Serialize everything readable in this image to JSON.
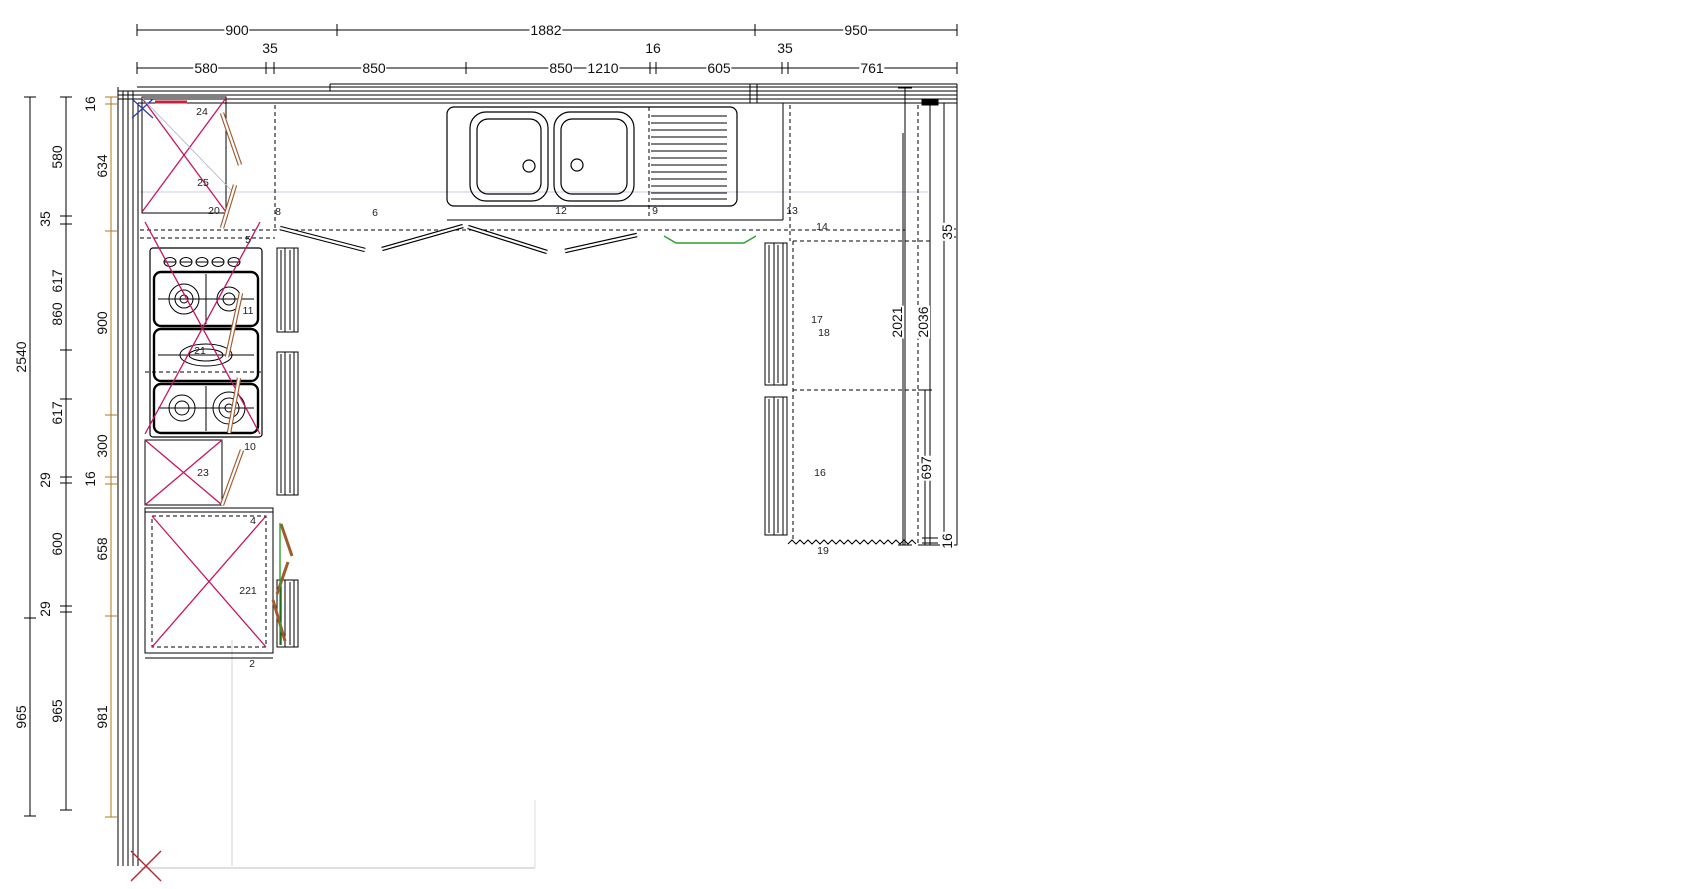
{
  "canvas": {
    "width": 1684,
    "height": 889,
    "background": "#ffffff"
  },
  "colors": {
    "line": "#000000",
    "magenta_cross": "#c81464",
    "crimson_mark": "#c0233a",
    "blue_mark": "#2939b0",
    "brown_door": "#a05a2c",
    "orange_chain": "#b07820",
    "green_highlight": "#2ca02c",
    "lavender_guide": "#c8c8e8",
    "gray_guide": "#cccccc"
  },
  "dimensions": {
    "top_row1": [
      {
        "t": "900",
        "x": 237,
        "y": 30
      },
      {
        "t": "1882",
        "x": 546,
        "y": 30
      },
      {
        "t": "950",
        "x": 856,
        "y": 30
      }
    ],
    "top_row2": [
      {
        "t": "580",
        "x": 206,
        "y": 68
      },
      {
        "t": "850",
        "x": 374,
        "y": 68
      },
      {
        "t": "850",
        "x": 561,
        "y": 68
      },
      {
        "t": "1210",
        "x": 603,
        "y": 68
      },
      {
        "t": "605",
        "x": 719,
        "y": 68
      },
      {
        "t": "761",
        "x": 872,
        "y": 68
      }
    ],
    "top_small": [
      {
        "t": "35",
        "x": 270,
        "y": 48
      },
      {
        "t": "16",
        "x": 653,
        "y": 48
      },
      {
        "t": "35",
        "x": 785,
        "y": 48
      }
    ],
    "left": [
      {
        "t": "2540",
        "x": 21,
        "y": 357
      },
      {
        "t": "965",
        "x": 21,
        "y": 717
      },
      {
        "t": "580",
        "x": 57,
        "y": 157
      },
      {
        "t": "35",
        "x": 45,
        "y": 219
      },
      {
        "t": "617",
        "x": 57,
        "y": 281
      },
      {
        "t": "860",
        "x": 57,
        "y": 314
      },
      {
        "t": "617",
        "x": 57,
        "y": 413
      },
      {
        "t": "29",
        "x": 45,
        "y": 480
      },
      {
        "t": "600",
        "x": 57,
        "y": 544
      },
      {
        "t": "29",
        "x": 45,
        "y": 609
      },
      {
        "t": "965",
        "x": 57,
        "y": 711
      },
      {
        "t": "16",
        "x": 90,
        "y": 104
      },
      {
        "t": "634",
        "x": 102,
        "y": 166
      },
      {
        "t": "900",
        "x": 102,
        "y": 323
      },
      {
        "t": "300",
        "x": 102,
        "y": 446
      },
      {
        "t": "16",
        "x": 90,
        "y": 479
      },
      {
        "t": "658",
        "x": 102,
        "y": 549
      },
      {
        "t": "981",
        "x": 102,
        "y": 717
      }
    ],
    "right": [
      {
        "t": "35",
        "x": 947,
        "y": 232
      },
      {
        "t": "2021",
        "x": 897,
        "y": 322
      },
      {
        "t": "2036",
        "x": 923,
        "y": 322
      },
      {
        "t": "697",
        "x": 926,
        "y": 468
      },
      {
        "t": "16",
        "x": 947,
        "y": 541
      }
    ]
  },
  "items": [
    {
      "t": "24",
      "x": 202,
      "y": 112
    },
    {
      "t": "25",
      "x": 203,
      "y": 183
    },
    {
      "t": "20",
      "x": 214,
      "y": 211
    },
    {
      "t": "5",
      "x": 248,
      "y": 240
    },
    {
      "t": "11",
      "x": 248,
      "y": 311
    },
    {
      "t": "21",
      "x": 200,
      "y": 351
    },
    {
      "t": "10",
      "x": 250,
      "y": 447
    },
    {
      "t": "23",
      "x": 203,
      "y": 473
    },
    {
      "t": "4",
      "x": 253,
      "y": 521
    },
    {
      "t": "221",
      "x": 248,
      "y": 591
    },
    {
      "t": "2",
      "x": 252,
      "y": 664
    },
    {
      "t": "8",
      "x": 278,
      "y": 212
    },
    {
      "t": "6",
      "x": 375,
      "y": 213
    },
    {
      "t": "12",
      "x": 561,
      "y": 211
    },
    {
      "t": "9",
      "x": 655,
      "y": 211
    },
    {
      "t": "13",
      "x": 792,
      "y": 211
    },
    {
      "t": "14",
      "x": 822,
      "y": 227
    },
    {
      "t": "17",
      "x": 817,
      "y": 320
    },
    {
      "t": "18",
      "x": 824,
      "y": 333
    },
    {
      "t": "16",
      "x": 820,
      "y": 473
    },
    {
      "t": "19",
      "x": 823,
      "y": 551
    }
  ]
}
